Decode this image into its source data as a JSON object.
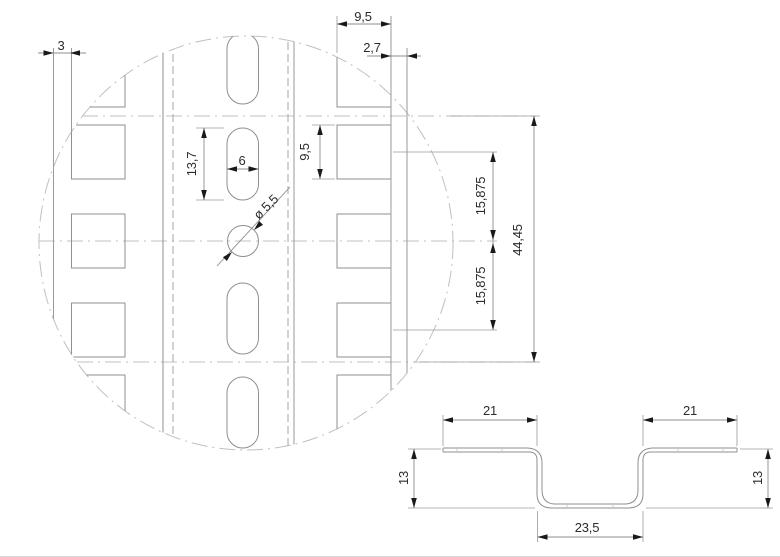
{
  "drawing": {
    "type": "technical-drawing",
    "colors": {
      "background": "#ffffff",
      "geometry_line": "#9a9a9a",
      "hidden_line": "#a6a6a6",
      "chain_line": "#c0c0c0",
      "dimension_text": "#2b2b2b",
      "arrow": "#1a1a1a"
    },
    "top_view": {
      "labels": {
        "edge_margin_left": "3",
        "slot_column_width": "9,5",
        "edge_margin_right": "2,7",
        "slot_length": "13,7",
        "slot_width": "6",
        "square_hole_size": "9,5",
        "hole_diameter": "ø 5,5",
        "hole_pitch_upper": "15,875",
        "hole_pitch_lower": "15,875",
        "overall_length": "44,45"
      }
    },
    "section_view": {
      "labels": {
        "flange_width_left": "21",
        "flange_width_right": "21",
        "height_left": "13",
        "height_right": "13",
        "base_width": "23,5"
      }
    }
  }
}
